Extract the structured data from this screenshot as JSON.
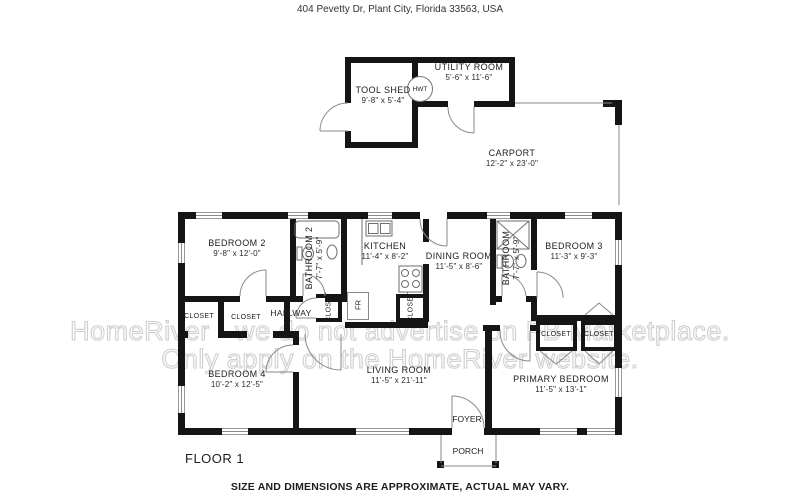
{
  "title": "404 Pevetty Dr, Plant City, Florida 33563, USA",
  "floor_label": "FLOOR 1",
  "disclaimer": "SIZE AND DIMENSIONS ARE APPROXIMATE, ACTUAL MAY VARY.",
  "watermark": {
    "line1": "HomeRiver - we do not advertise on FB Marketplace.",
    "line2": "Only apply on the HomeRiver website."
  },
  "rooms": {
    "tool_shed": {
      "name": "TOOL SHED",
      "dims": "9'-8\" x 5'-4\""
    },
    "utility_room": {
      "name": "UTILITY ROOM",
      "dims": "5'-6\" x 11'-6\""
    },
    "carport": {
      "name": "CARPORT",
      "dims": "12'-2\" x 23'-0\""
    },
    "bedroom_2": {
      "name": "BEDROOM 2",
      "dims": "9'-8\" x 12'-0\""
    },
    "bathroom_2": {
      "name": "BATHROOM 2",
      "dims": "7'-7\" x 5'-9\""
    },
    "kitchen": {
      "name": "KITCHEN",
      "dims": "11'-4\" x 8'-2\""
    },
    "dining_room": {
      "name": "DINING ROOM",
      "dims": "11'-5\" x 8'-6\""
    },
    "bathroom": {
      "name": "BATHROOM",
      "dims": "7'-7\" x 5'-9\""
    },
    "bedroom_3": {
      "name": "BEDROOM 3",
      "dims": "11'-3\" x 9'-3\""
    },
    "bedroom_4": {
      "name": "BEDROOM 4",
      "dims": "10'-2\" x 12'-5\""
    },
    "living_room": {
      "name": "LIVING ROOM",
      "dims": "11'-5\" x 21'-11\""
    },
    "primary_bedroom": {
      "name": "PRIMARY BEDROOM",
      "dims": "11'-5\" x 13'-1\""
    },
    "hallway": {
      "name": "HALLWAY"
    },
    "foyer": {
      "name": "FOYER"
    },
    "porch": {
      "name": "PORCH"
    }
  },
  "fixtures": {
    "hwt": "HWT",
    "fridge": "FR",
    "closet": "CLOSET"
  },
  "colors": {
    "wall": "#151515",
    "thin_line": "#8a8a8a",
    "label": "#1c1c1c",
    "watermark_outline": "#cfcfcf",
    "background": "#ffffff"
  }
}
